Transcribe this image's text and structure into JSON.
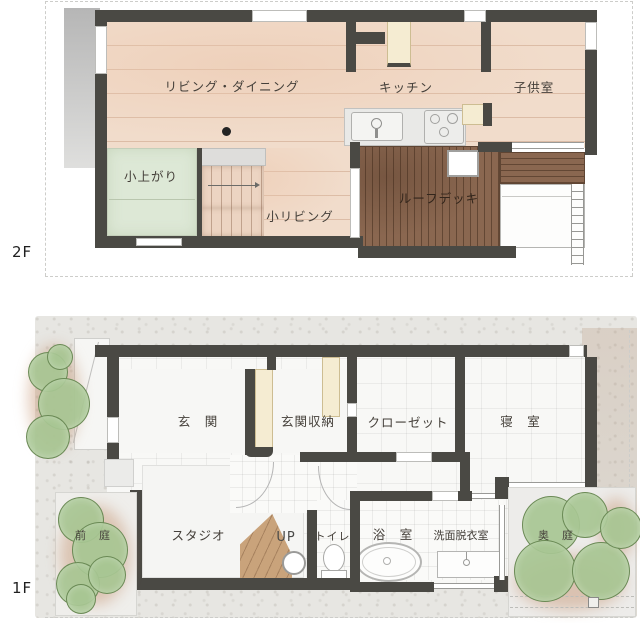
{
  "title": "2-story house floor plan",
  "floors": {
    "f2": {
      "marker": "2F",
      "rooms": {
        "living_dining": "リビング・ダイニング",
        "kitchen": "キッチン",
        "kids_room": "子供室",
        "koagari": "小上がり",
        "small_living": "小リビング",
        "roof_deck": "ルーフデッキ"
      }
    },
    "f1": {
      "marker": "1F",
      "rooms": {
        "entrance": "玄　関",
        "entrance_storage": "玄関収納",
        "closet": "クローゼット",
        "bedroom": "寝　室",
        "studio": "スタジオ",
        "stairs_up": "UP",
        "toilet": "トイレ",
        "bath": "浴　室",
        "washroom": "洗面脱衣室",
        "front_garden": "前　庭",
        "back_garden": "奥　庭"
      }
    }
  },
  "colors": {
    "wall": "#4a4944",
    "wood_floor": "#f1dccb",
    "tatami": "#dde8d6",
    "deck": "#8a6750",
    "cream": "#f5ecd2",
    "tile_floor": "#f8f8f6",
    "site": "#e7e6e2",
    "tree": "#a7c592",
    "soil": "#c4906c",
    "stair_wood": "#c9a37b",
    "label": "#45403a"
  }
}
